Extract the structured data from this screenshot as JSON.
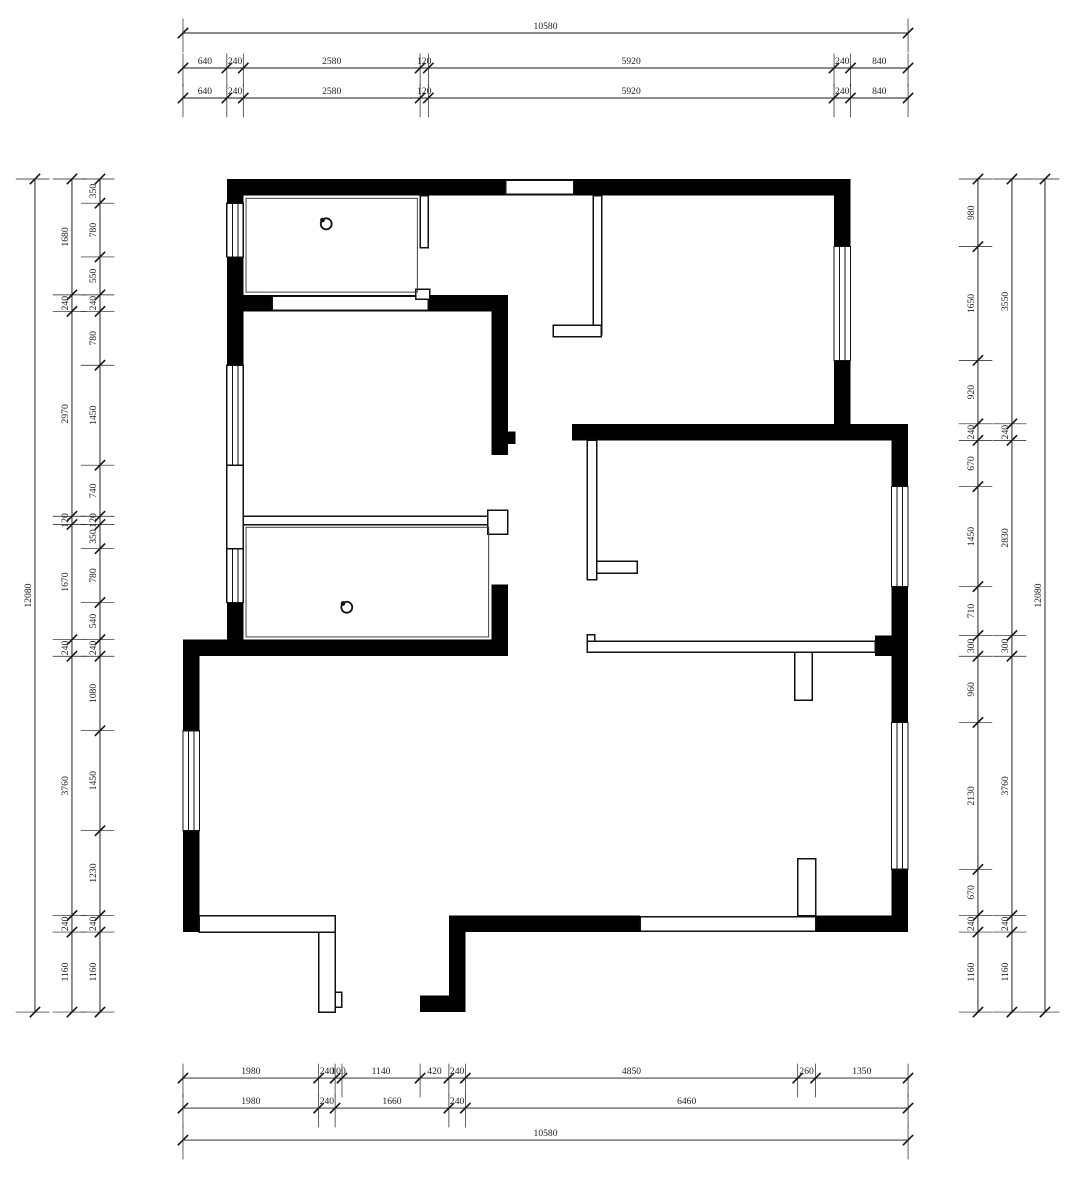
{
  "drawing": {
    "type": "floor-plan",
    "units": "mm",
    "overall_width_mm": 10580,
    "overall_height_mm": 12080,
    "colors": {
      "wall": "#000000",
      "background": "#ffffff",
      "line": "#1a1a1a",
      "text": "#222222"
    }
  },
  "dimensions": {
    "top": {
      "total": [
        10580
      ],
      "row2": [
        640,
        240,
        2580,
        120,
        5920,
        240,
        840
      ],
      "row3": [
        640,
        240,
        2580,
        120,
        5920,
        240,
        840
      ]
    },
    "bottom": {
      "row1": [
        1980,
        240,
        100,
        1140,
        420,
        240,
        4850,
        260,
        1350
      ],
      "row2": [
        1980,
        240,
        1660,
        240,
        6460
      ],
      "total": [
        10580
      ]
    },
    "left": {
      "total": [
        12080
      ],
      "mid": [
        1680,
        240,
        2970,
        120,
        1670,
        240,
        3760,
        240,
        1160
      ],
      "inner": [
        350,
        780,
        550,
        240,
        780,
        1450,
        740,
        120,
        350,
        780,
        540,
        240,
        1080,
        1450,
        1230,
        240,
        1160
      ]
    },
    "right": {
      "inner": [
        980,
        1650,
        920,
        240,
        670,
        1450,
        710,
        300,
        960,
        2130,
        670,
        240,
        1160
      ],
      "mid": [
        3550,
        240,
        2830,
        300,
        3760,
        240,
        1160
      ],
      "total": [
        12080
      ]
    }
  }
}
